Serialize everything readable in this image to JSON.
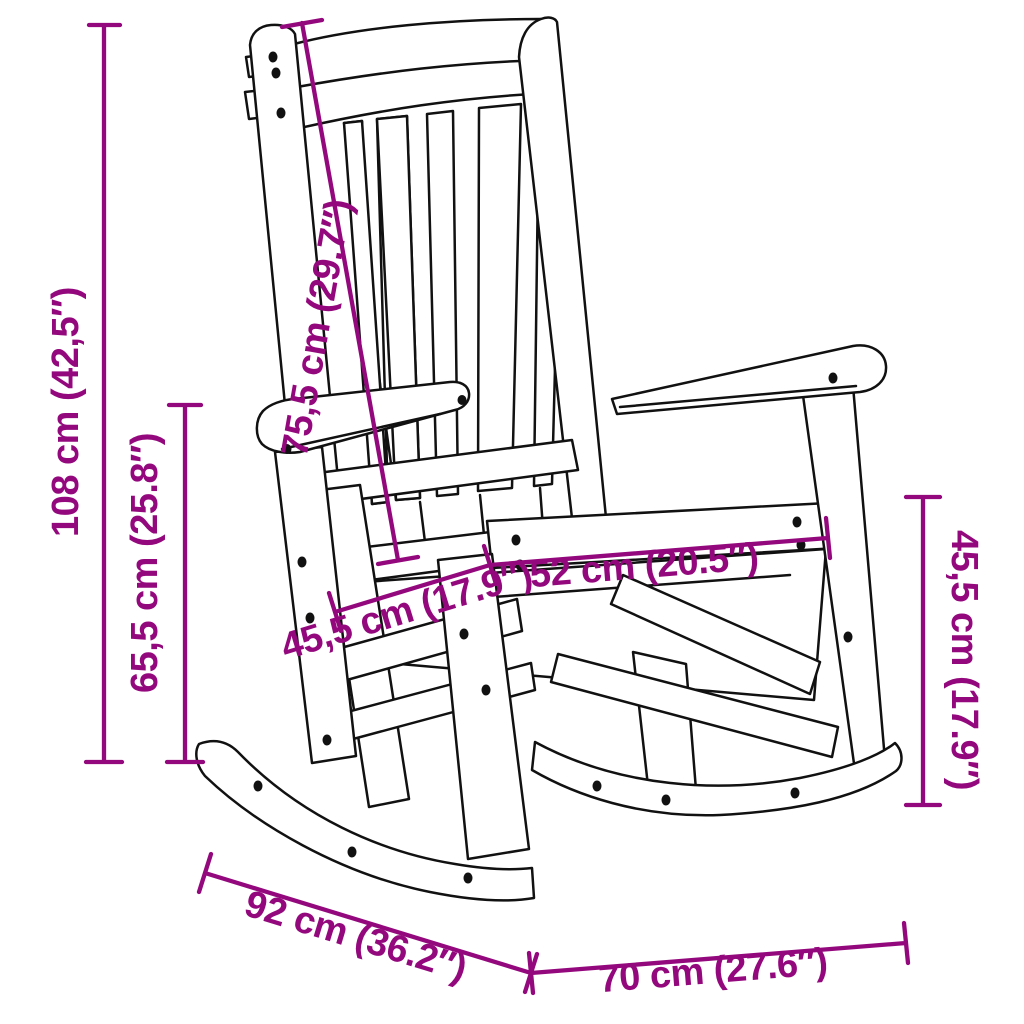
{
  "diagram": {
    "kind": "product-dimension-diagram",
    "product": "rocking-chair-line-art",
    "background_color": "#ffffff",
    "outline_color": "#111111",
    "accent_color": "#94087D",
    "dimensions": [
      {
        "id": "overall-height",
        "label": "108 cm (42,5″)",
        "value_cm": "108",
        "value_inch": "42,5"
      },
      {
        "id": "height-to-armrest",
        "label": "65,5 cm (25.8″)",
        "value_cm": "65,5",
        "value_inch": "25.8"
      },
      {
        "id": "backrest-length",
        "label": "75,5 cm (29.7″)",
        "value_cm": "75,5",
        "value_inch": "29.7"
      },
      {
        "id": "seat-depth",
        "label": "45,5 cm (17.9″)",
        "value_cm": "45,5",
        "value_inch": "17.9"
      },
      {
        "id": "seat-width",
        "label": "52 cm (20.5″)",
        "value_cm": "52",
        "value_inch": "20.5"
      },
      {
        "id": "seat-height",
        "label": "45,5 cm (17.9″)",
        "value_cm": "45,5",
        "value_inch": "17.9"
      },
      {
        "id": "overall-depth",
        "label": "92 cm (36.2″)",
        "value_cm": "92",
        "value_inch": "36.2"
      },
      {
        "id": "overall-width",
        "label": "70 cm (27.6″)",
        "value_cm": "70",
        "value_inch": "27.6"
      }
    ]
  }
}
